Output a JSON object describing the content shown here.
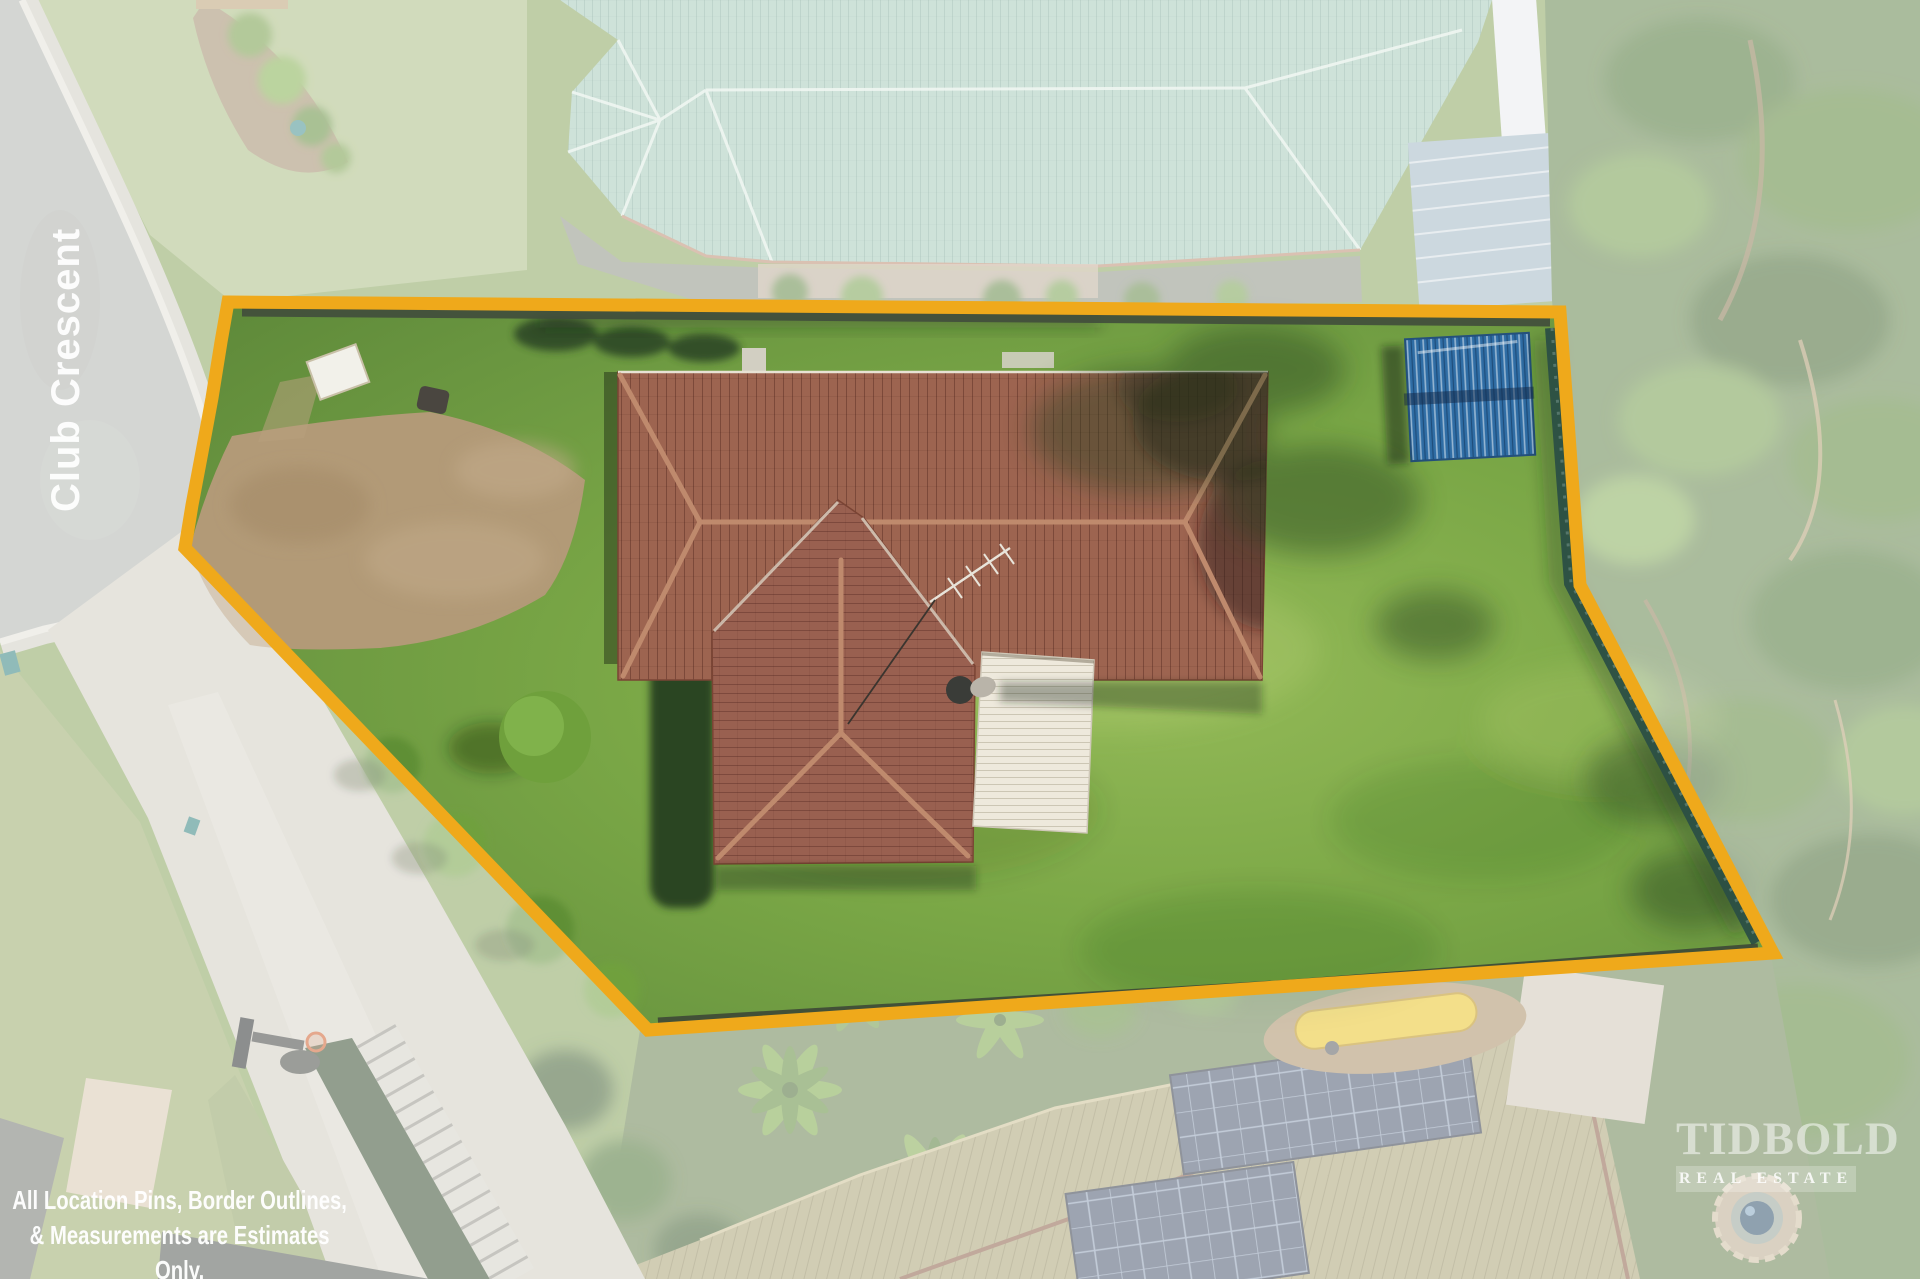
{
  "overlay": {
    "street_label": "Club Crescent",
    "disclaimer": {
      "line1": "All Location Pins, Border Outlines,",
      "line2": "& Measurements are Estimates Only.",
      "line3": "Illustrative Purposes Only."
    },
    "watermark": {
      "brand": "TIDBOLD",
      "tagline": "REAL ESTATE"
    }
  },
  "colors": {
    "boundary_gold": "#EFA91B",
    "lawn_green": "#7BA344",
    "roof_tile_brown": "#9D6450",
    "neighbour_roof_teal": "#A3C9B8",
    "neighbour_roof_olive": "#A9A172",
    "garden_shed_blue": "#2F6DA5",
    "road_asphalt_gray": "#AFB2AD",
    "driveway_dirt_tan": "#B29A77",
    "patio_roof_white": "#EEE9DC",
    "kayak_yellow": "#E9C322"
  }
}
